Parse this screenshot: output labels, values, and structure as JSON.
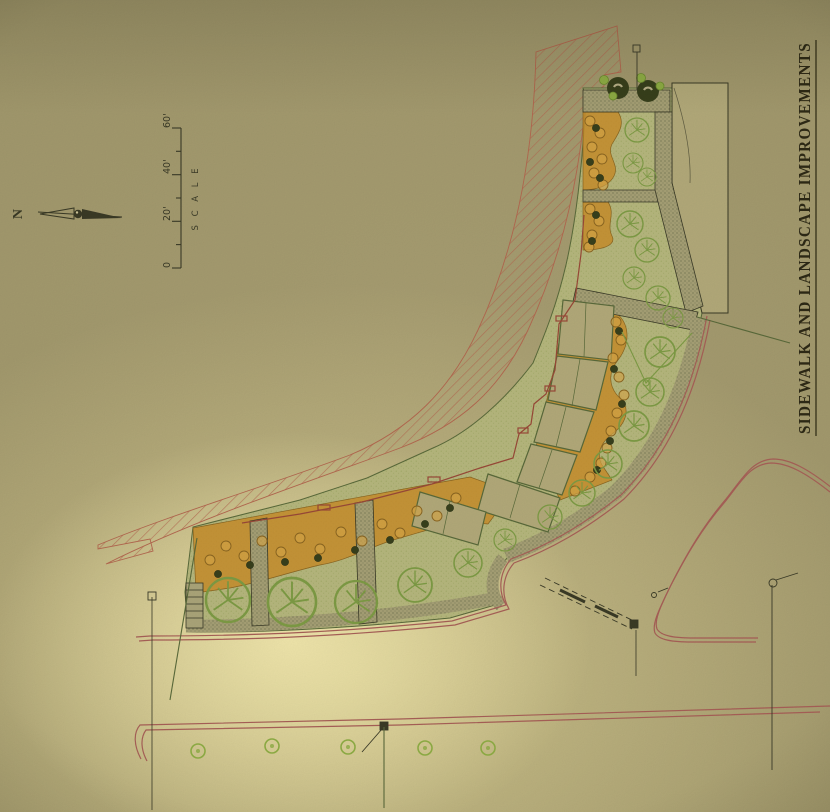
{
  "title_block": {
    "title": "SIDEWALK AND LANDSCAPE IMPROVEMENTS"
  },
  "north_arrow": {
    "label": "N"
  },
  "scale_bar": {
    "label": "S C A L E",
    "ticks": [
      "0",
      "20'",
      "40'",
      "60'"
    ]
  },
  "colors": {
    "paper": "#a89e72",
    "paper_bright": "#e6daa2",
    "paper_shadow": "#857c59",
    "hatch_red": "#b46850",
    "bed_orange": "#c8902e",
    "bed_orange_light": "#d8a848",
    "lawn_green": "#b7b87e",
    "lawn_dot": "#93a257",
    "tree_green": "#7e9c45",
    "dark_foliage": "#39411f",
    "bright_green": "#8fae44",
    "stipple_bg": "#a7a176",
    "stipple_dot": "#5c6142",
    "building_fill": "#b3aa7a",
    "line_dark": "#3a3a28",
    "line_green": "#5a6a3a",
    "accent_red": "#9a4a38",
    "curb_pink": "#a86058",
    "ink": "#2e2a16"
  }
}
